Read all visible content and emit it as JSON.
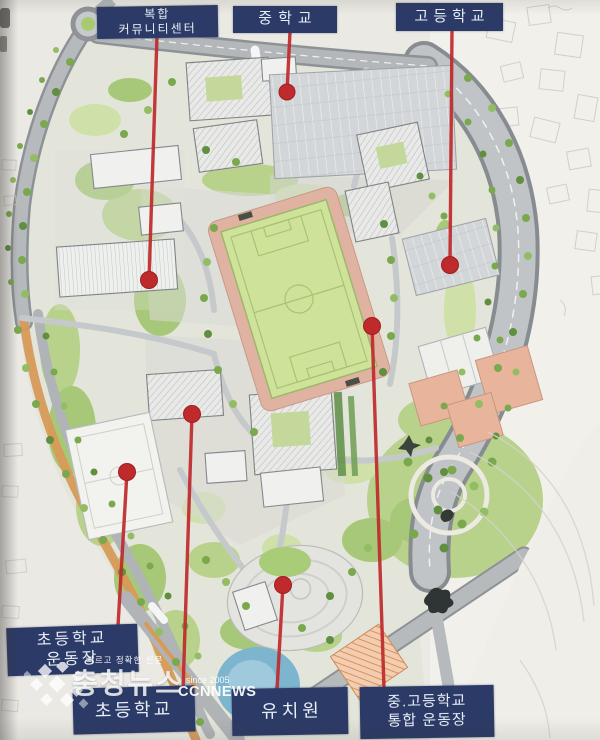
{
  "labels": [
    {
      "id": "community-center",
      "lines": [
        "복합",
        "커뮤니티센터"
      ]
    },
    {
      "id": "middle-school",
      "lines": [
        "중학교"
      ]
    },
    {
      "id": "high-school",
      "lines": [
        "고등학교"
      ]
    },
    {
      "id": "elementary-playground",
      "lines": [
        "초등학교",
        "운동장"
      ]
    },
    {
      "id": "elementary-school",
      "lines": [
        "초등학교"
      ]
    },
    {
      "id": "kindergarten",
      "lines": [
        "유치원"
      ]
    },
    {
      "id": "mid-high-integrated-field",
      "lines": [
        "중.고등학교",
        "통합 운동장"
      ]
    }
  ],
  "watermark": {
    "tagline": "빠르고 정확한 신문",
    "name": "충청뉴스",
    "since": "since 2005",
    "brand": "CCNNEWS"
  },
  "colors": {
    "paper": "#ebe9e4",
    "label-bg": "#2b3a66",
    "label-text": "#e8edf6",
    "callout-red": "#bf2a2c",
    "field-green": "#cfe29a",
    "track-pink": "#e0b2a1",
    "court-salmon": "#e9b49c",
    "pond-blue": "#7db5cf",
    "road-gray": "#b4b8bb",
    "tree-green": "#79a94c"
  }
}
